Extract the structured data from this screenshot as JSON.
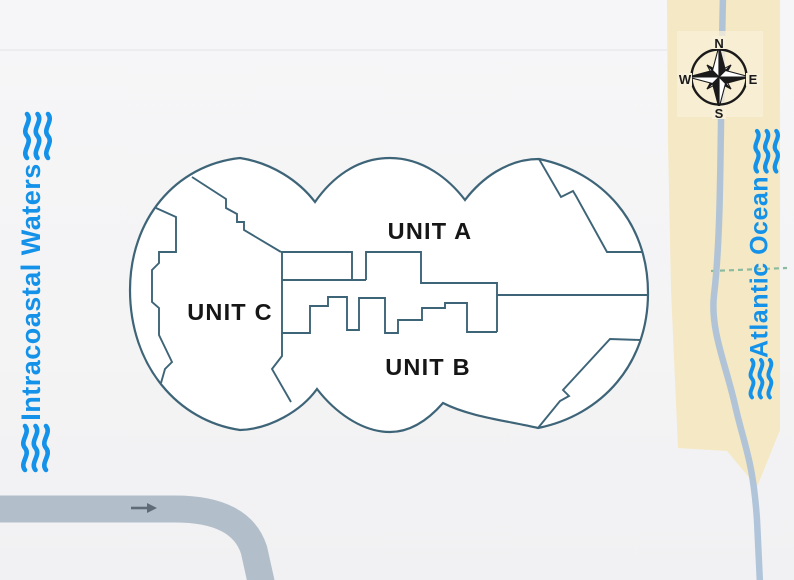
{
  "title": "Site plan with unit layout",
  "units": {
    "a": {
      "label": "UNIT A"
    },
    "b": {
      "label": "UNIT B"
    },
    "c": {
      "label": "UNIT C"
    }
  },
  "waterways": {
    "left": {
      "label": "Intracoastal Waters"
    },
    "right": {
      "label": "Atlantic Ocean"
    }
  },
  "compass": {
    "north": "N",
    "east": "E",
    "south": "S",
    "west": "W"
  },
  "icons": {
    "waves": "waves-icon",
    "compass_rose": "compass-rose-icon",
    "direction_arrow": "arrow-right-icon"
  },
  "colors": {
    "background": "#f4f4f5",
    "water_label": "#1492e9",
    "building_outline": "#3e6478",
    "building_fill": "#ffffff",
    "beach": "#f5e8c4",
    "beach_patch": "#f8f0d8",
    "road_main": "#b2bfca",
    "road_coastal": "#adc2d8",
    "dashed_boundary": "#8abb9f",
    "unit_label": "#161616",
    "compass_ink": "#1a1a1a",
    "arrow": "#5f6b77"
  }
}
